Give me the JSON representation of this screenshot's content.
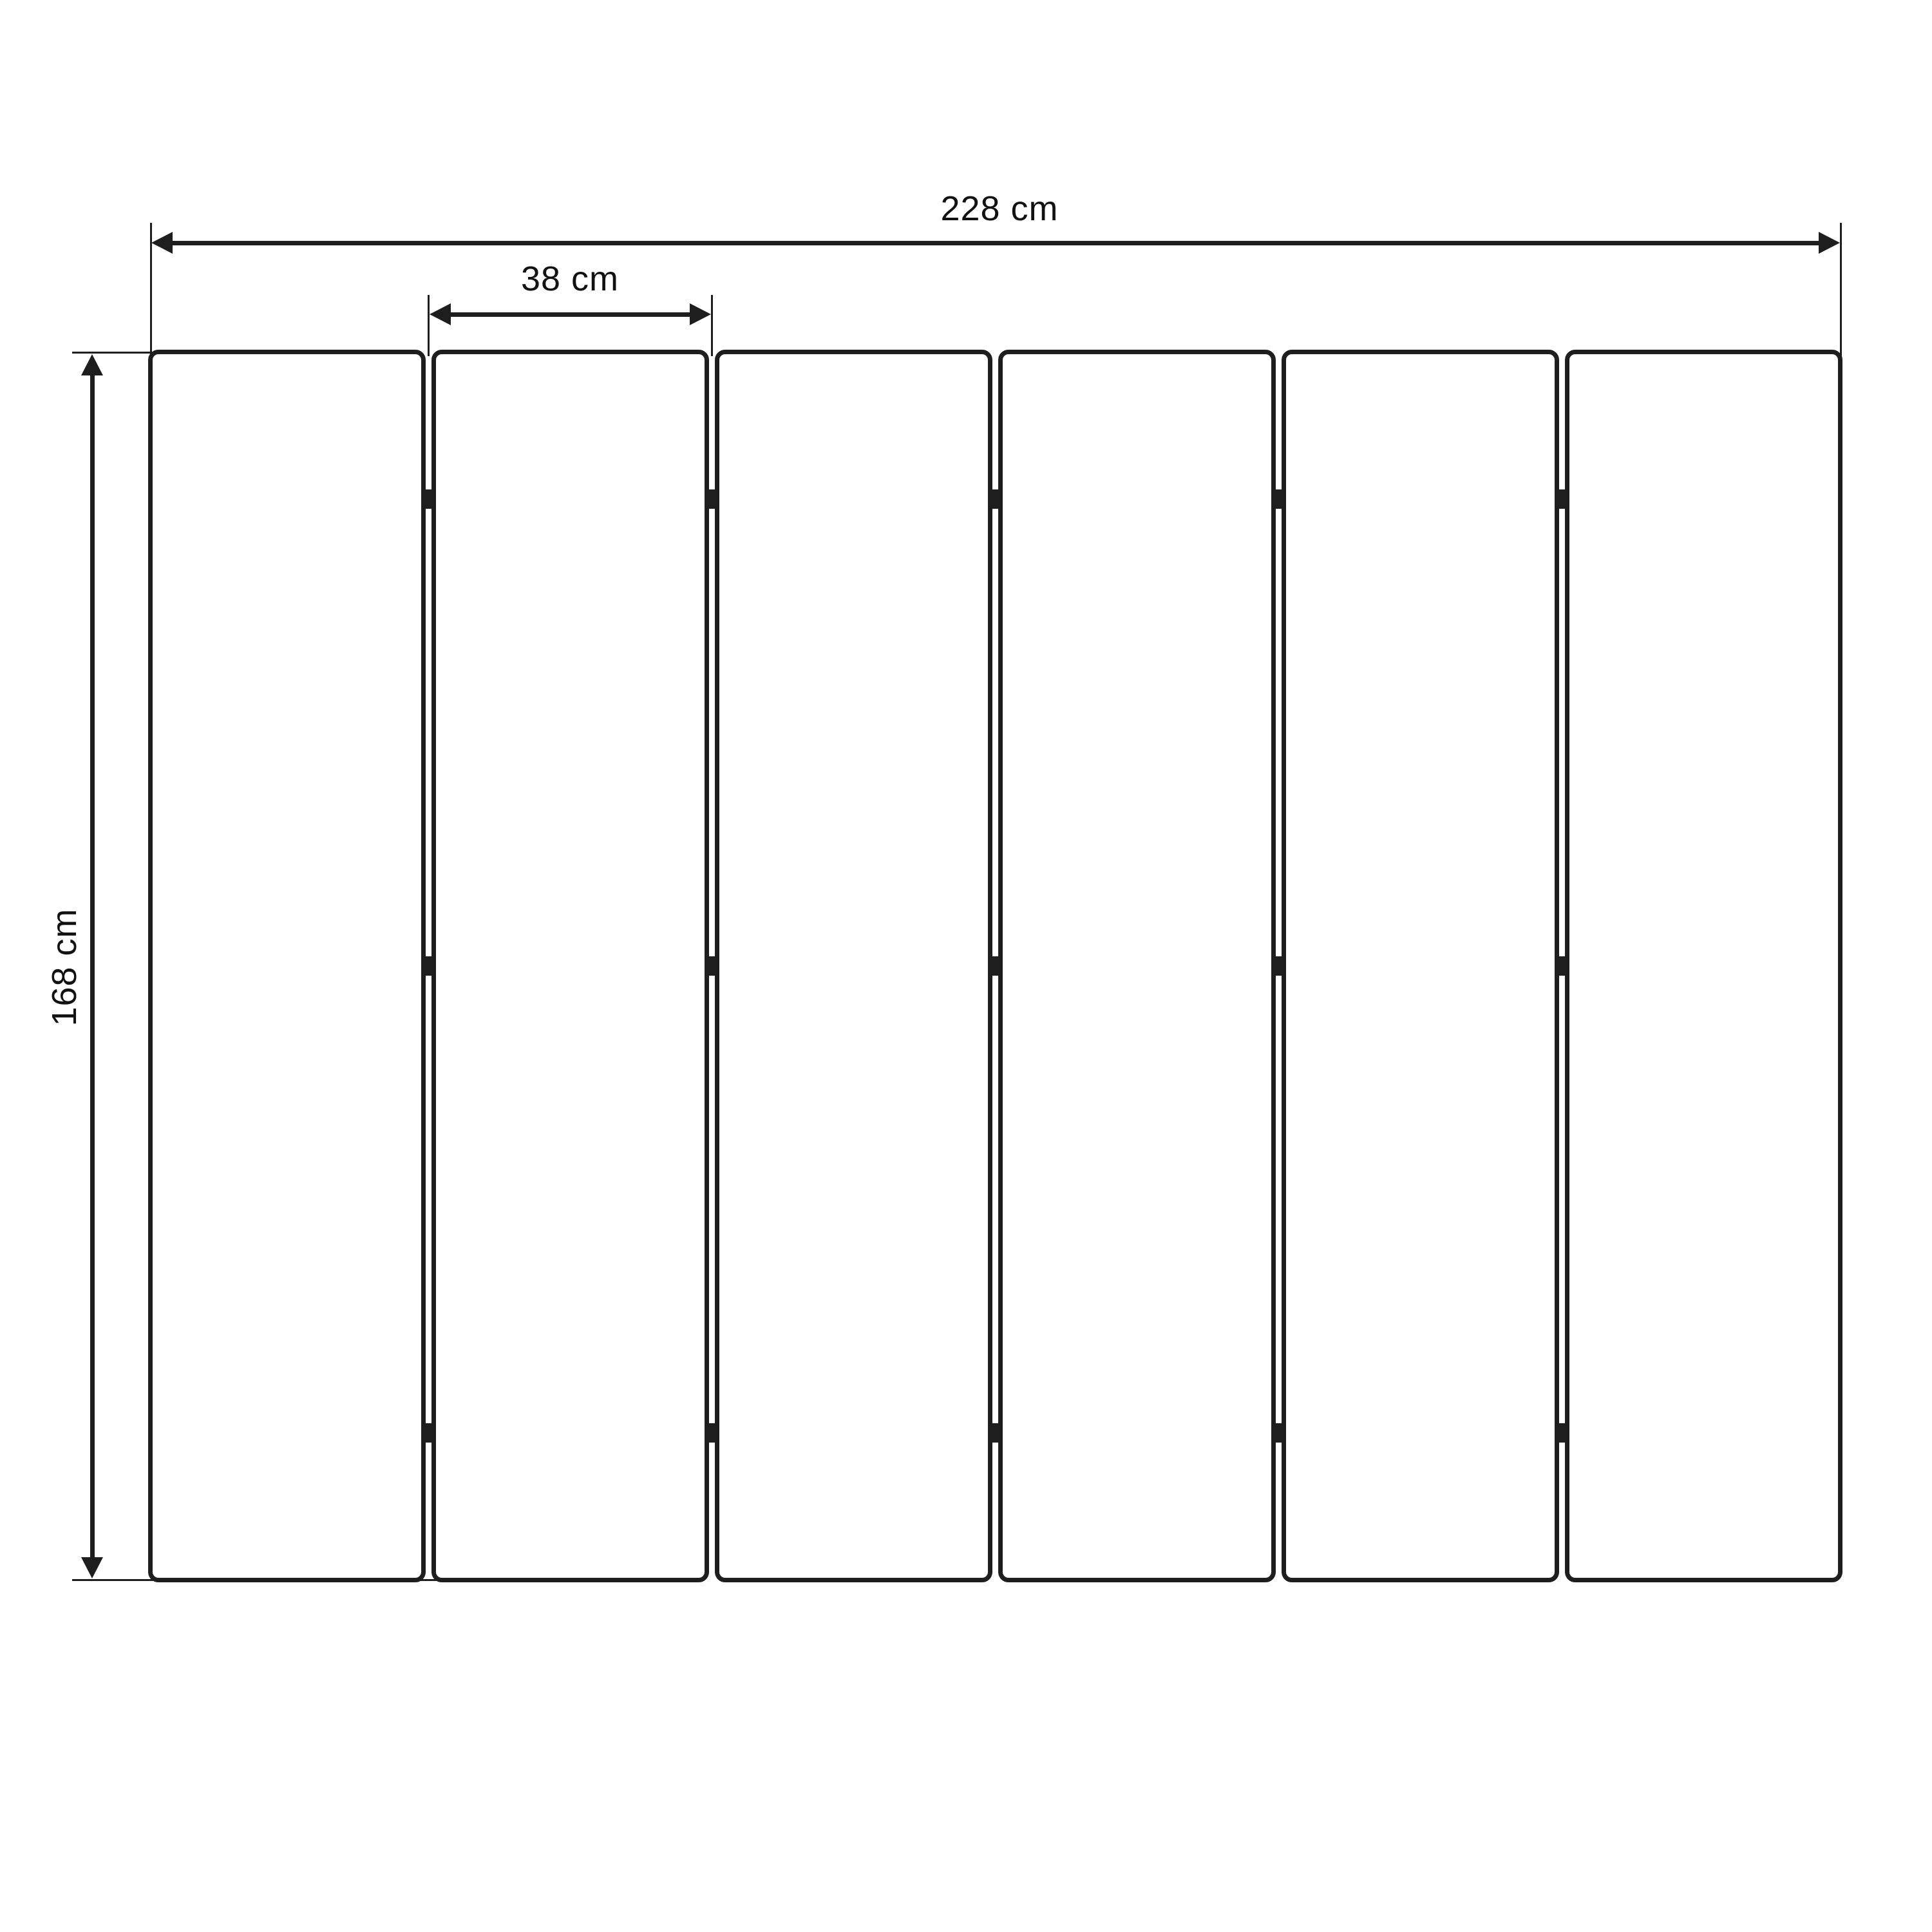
{
  "figure": {
    "type": "dimensioned-drawing",
    "subject": "six-slat folding panel, front view",
    "background_color": "#ffffff",
    "stroke_color": "#1e1e1e",
    "text_color": "#111111"
  },
  "dimensions": {
    "total_width": {
      "label": "228 cm",
      "value": 228,
      "unit": "cm"
    },
    "slat_width": {
      "label": "38 cm",
      "value": 38,
      "unit": "cm"
    },
    "height": {
      "label": "168 cm",
      "value": 168,
      "unit": "cm"
    }
  },
  "panel": {
    "slat_count": 6,
    "gap_count": 5,
    "hinge_marks_per_gap": 3
  }
}
